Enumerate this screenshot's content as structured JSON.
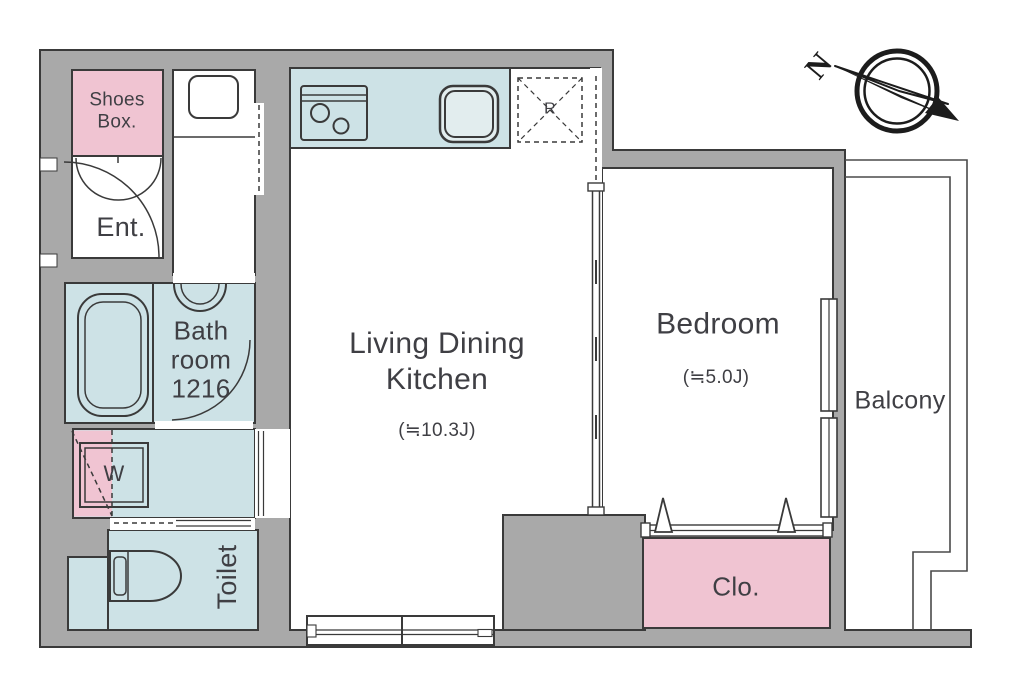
{
  "title": "Apartment floor plan",
  "colors": {
    "wall": "#a9a9a9",
    "outline": "#3a3a3a",
    "pink": "#f0c4d2",
    "blue": "#cde2e6",
    "text": "#3f3f44",
    "rail": "#4a4a4a"
  },
  "rooms": {
    "shoes_box": {
      "label": "Shoes\nBox."
    },
    "entrance": {
      "label": "Ent."
    },
    "bathroom": {
      "label": "Bath\nroom\n1216"
    },
    "washer": {
      "label": "W"
    },
    "toilet": {
      "label": "Toilet"
    },
    "ldk": {
      "label": "Living Dining\nKitchen",
      "size": "(≒10.3J)"
    },
    "bedroom": {
      "label": "Bedroom",
      "size": "(≒5.0J)"
    },
    "balcony": {
      "label": "Balcony"
    },
    "closet": {
      "label": "Clo."
    },
    "refrigerator": {
      "label": "R"
    }
  },
  "compass": {
    "north_label": "N"
  }
}
